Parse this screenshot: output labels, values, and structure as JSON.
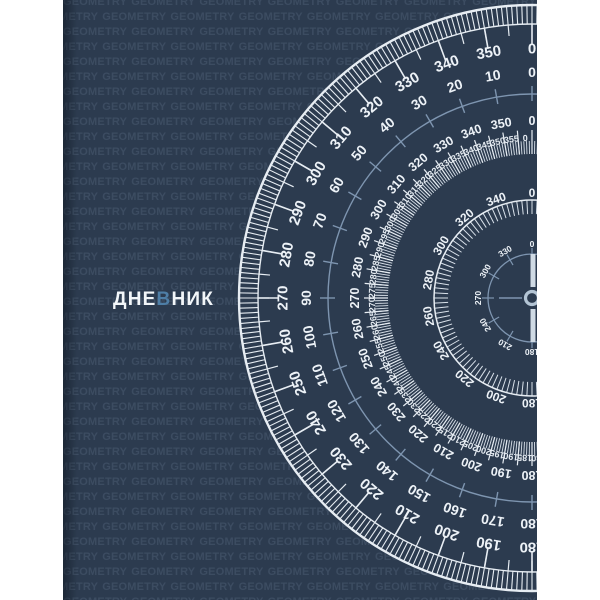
{
  "page": {
    "background": "#ffffff"
  },
  "cover": {
    "background": "#2c3b4f",
    "pattern": {
      "word": "GEOMETRY",
      "color": "rgba(168,192,222,0.13)",
      "font_size": 11,
      "row_pitch": 15,
      "row_count": 41,
      "repeats": 11,
      "alt_offset": -29,
      "letter_spacing": 0.2,
      "word_spacing": 1
    },
    "title": {
      "prefix": "ДНЕ",
      "accent": "В",
      "suffix": "НИК",
      "color": "#f2f6f9",
      "accent_color": "#4e7ea6",
      "x": 50,
      "y": 289,
      "font_size": 19,
      "letter_spacing": 1.2
    }
  },
  "protractor": {
    "center": {
      "x": 469,
      "y": 298
    },
    "colors": {
      "white": "#e7edf3",
      "dim_white": "#d9e1ea",
      "number": "#edf2f7",
      "light_blue": "#7e95b0",
      "hub": "#b3c4d4",
      "cross_bar": "#cfdae4"
    },
    "rings": [
      {
        "id": "dial-face",
        "type": "disc",
        "r": 294,
        "color": "#2c3b4f"
      },
      {
        "id": "outer-band",
        "type": "band",
        "r_inner": 274,
        "r_outer": 293,
        "tick_step": 1,
        "color": "#e7edf3",
        "outer_width": 2.4,
        "inner_width": 1.4,
        "tick_width": 1.1
      },
      {
        "id": "outer-ticks-10deg",
        "type": "ticks",
        "r1": 253,
        "r2": 274,
        "step": 10,
        "width": 1.6,
        "color": "#e7edf3"
      },
      {
        "id": "outer-ticks-5deg",
        "type": "ticks",
        "r1": 263,
        "r2": 274,
        "step": 5,
        "offset": 5,
        "width": 1.2,
        "color": "#e7edf3"
      },
      {
        "id": "outer-scale-clockwise",
        "type": "labels",
        "radius": 249,
        "font_size": 15,
        "mode": "cw",
        "color": "#edf2f7",
        "labels": [
          0,
          350,
          340,
          330,
          320,
          310,
          300,
          290,
          280,
          270,
          260,
          250,
          240,
          230,
          220,
          210,
          200,
          190,
          180
        ]
      },
      {
        "id": "outer-scale-counterclockwise",
        "type": "labels",
        "radius": 226,
        "font_size": 14,
        "mode": "ccw",
        "color": "#edf2f7",
        "labels": [
          0,
          10,
          20,
          30,
          40,
          50,
          60,
          70,
          80,
          90,
          100,
          110,
          120,
          130,
          140,
          150,
          160,
          170,
          180
        ]
      },
      {
        "id": "blue-ring-circle",
        "type": "circle",
        "r": 204,
        "width": 1.4,
        "color": "#7e95b0"
      },
      {
        "id": "blue-ring-ticks",
        "type": "ticks",
        "r1": 197,
        "r2": 212,
        "step": 10,
        "width": 1.4,
        "color": "#7e95b0"
      },
      {
        "id": "third-scale-10deg",
        "type": "labels",
        "radius": 177,
        "font_size": 12.5,
        "mode": "cw",
        "color": "#edf2f7",
        "labels": [
          0,
          350,
          340,
          330,
          320,
          310,
          300,
          290,
          280,
          270,
          260,
          250,
          240,
          230,
          220,
          210,
          200,
          190,
          180
        ]
      },
      {
        "id": "fine-band-1deg",
        "type": "ticks",
        "r1": 144,
        "r2": 157,
        "step": 1,
        "width": 0.9,
        "color": "#d9e1ea"
      },
      {
        "id": "fine-band-5deg",
        "type": "ticks",
        "r1": 144,
        "r2": 168,
        "step": 5,
        "width": 1.2,
        "color": "#e7edf3"
      },
      {
        "id": "fine-scale-5deg",
        "type": "labels",
        "radius": 160,
        "font_size": 9,
        "mode": "cw",
        "angle_offset": 2.4,
        "color": "#e7edf3",
        "labels": [
          0,
          355,
          350,
          345,
          340,
          335,
          330,
          325,
          320,
          315,
          310,
          305,
          300,
          295,
          290,
          285,
          280,
          275,
          270,
          265,
          260,
          255,
          250,
          245,
          240,
          235,
          230,
          225,
          220,
          215,
          210,
          205,
          200,
          195,
          190,
          185,
          180
        ]
      },
      {
        "id": "fifth-scale-20deg",
        "type": "labels",
        "radius": 105,
        "font_size": 12,
        "mode": "cw",
        "color": "#edf2f7",
        "labels": [
          0,
          340,
          320,
          300,
          280,
          260,
          240,
          220,
          200,
          180
        ]
      },
      {
        "id": "spiky-ring-ticks",
        "type": "ticks",
        "r1": 84,
        "r2": 98,
        "step": 3,
        "width": 1,
        "color": "#d9e1ea"
      },
      {
        "id": "spiky-ring-circle",
        "type": "circle",
        "r": 98,
        "width": 1.5,
        "color": "#e7edf3"
      },
      {
        "id": "compass-circle",
        "type": "circle",
        "r": 44,
        "width": 1.3,
        "color": "#7e95b0"
      },
      {
        "id": "compass-ticks-30deg",
        "type": "ticks",
        "r1": 38,
        "r2": 50,
        "step": 30,
        "width": 1.2,
        "color": "#7e95b0"
      },
      {
        "id": "compass-scale-30deg",
        "type": "labels",
        "radius": 54,
        "font_size": 8.5,
        "mode": "cw",
        "color": "#edf2f7",
        "labels": [
          0,
          330,
          300,
          270,
          240,
          210,
          180
        ]
      },
      {
        "id": "crosshair",
        "type": "cross",
        "segments": [
          {
            "x1": -10,
            "y1": 0,
            "x2": -33,
            "y2": 0,
            "width": 1.6,
            "color": "#7e95b0"
          },
          {
            "x1": 1,
            "y1": -44,
            "x2": 1,
            "y2": -11,
            "width": 5,
            "color": "#cfdae4"
          },
          {
            "x1": 1,
            "y1": 11,
            "x2": 1,
            "y2": 44,
            "width": 5,
            "color": "#cfdae4"
          }
        ]
      },
      {
        "id": "center-hub",
        "type": "hub",
        "r": 6.5,
        "width": 3.2,
        "color": "#b3c4d4"
      }
    ]
  }
}
